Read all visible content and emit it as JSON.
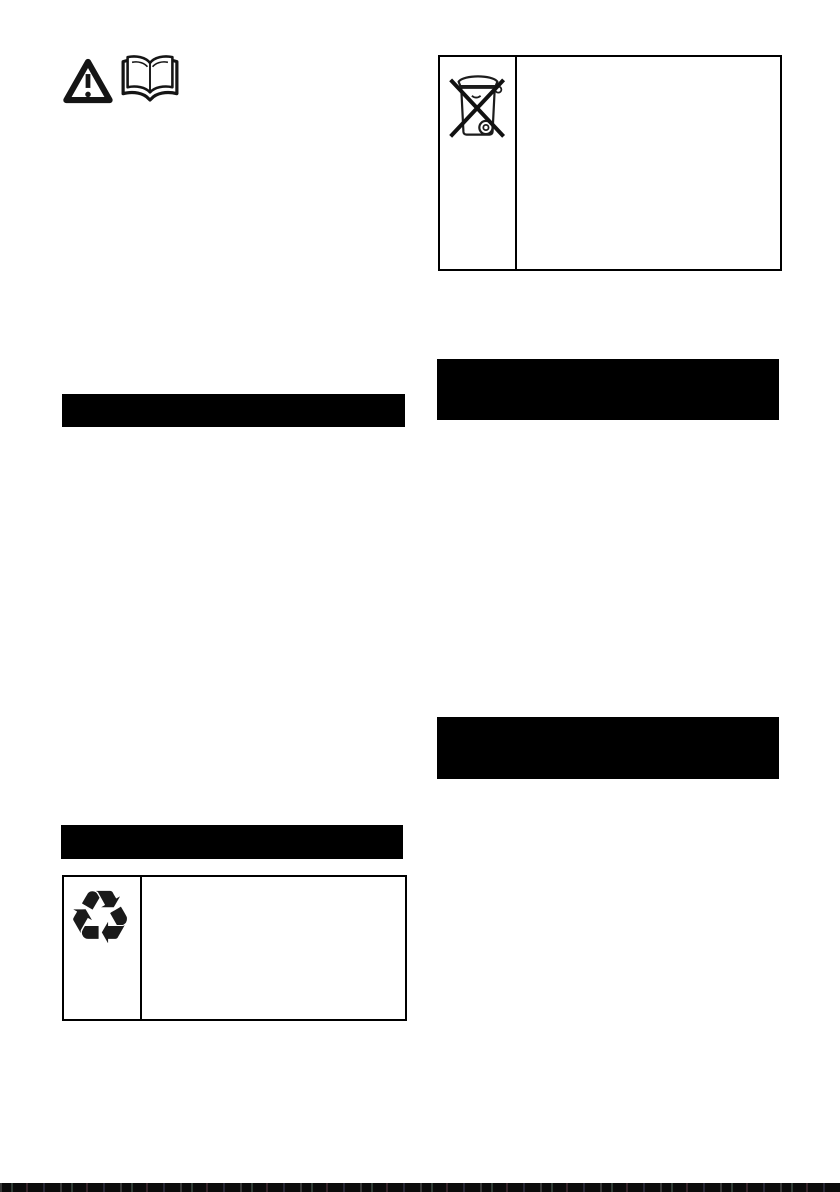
{
  "page": {
    "background": "#ffffff",
    "ink": "#000000",
    "heading_bar_color": "#000000"
  },
  "top_left_symbols": {
    "warning_icon": "warning-triangle",
    "manual_icon": "read-operating-manual-book"
  },
  "left_column": {
    "section_heading_1": {
      "label": "",
      "style": "blacked-out"
    },
    "section_heading_2": {
      "label": "",
      "style": "blacked-out"
    },
    "recycling_table": {
      "symbol_name": "recycling-mobius-loop",
      "symbol_glyph": "♻",
      "description_text": ""
    }
  },
  "right_column": {
    "weee_table": {
      "symbol_name": "weee-crossed-out-wheelie-bin",
      "description_text": ""
    },
    "section_heading_1": {
      "label": "",
      "style": "blacked-out"
    },
    "section_heading_2": {
      "label": "",
      "style": "blacked-out"
    }
  },
  "page_bottom": {
    "scan_edge": "dark-strip"
  }
}
